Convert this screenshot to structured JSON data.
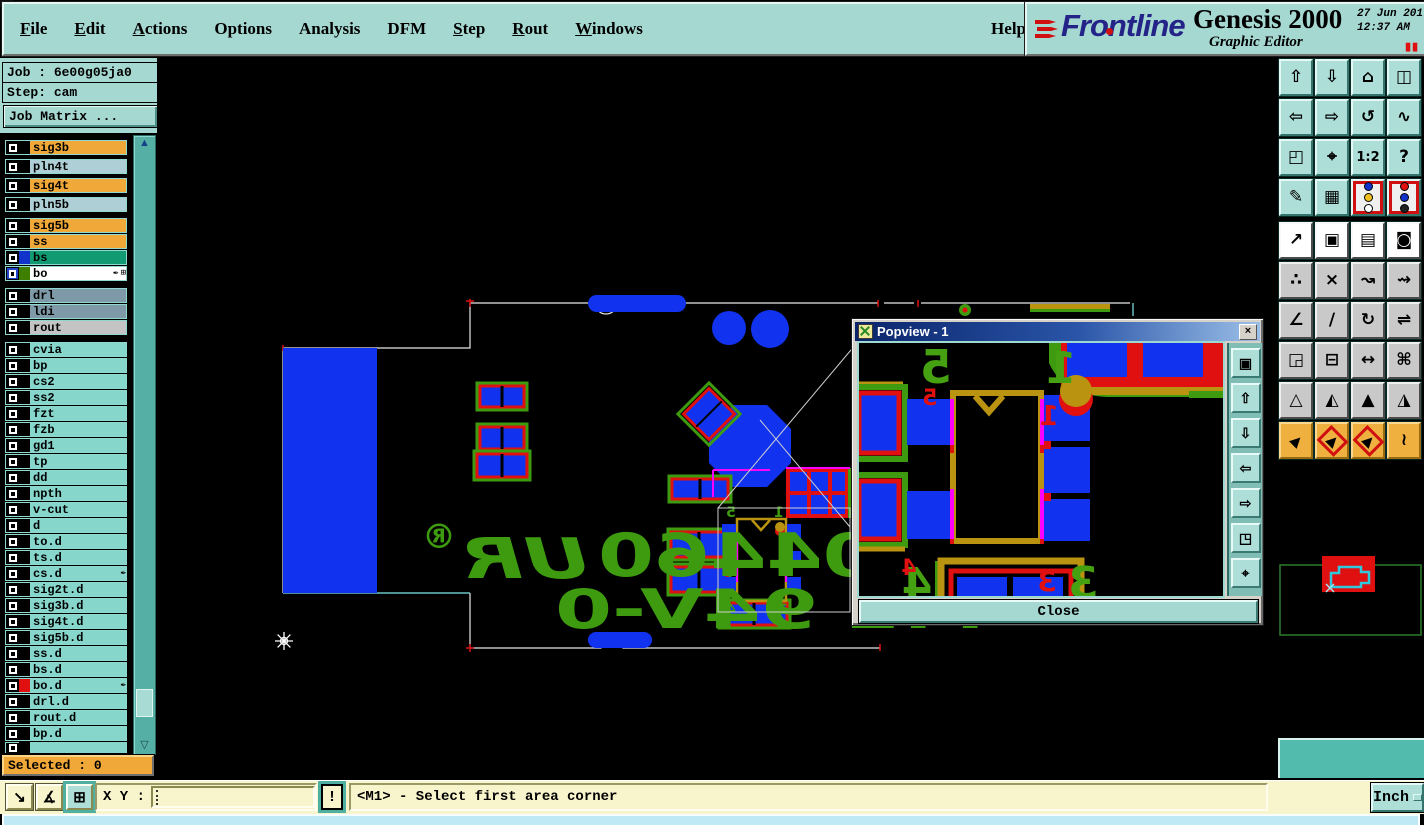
{
  "header": {
    "menus": [
      {
        "label": "File",
        "u": 0
      },
      {
        "label": "Edit",
        "u": 0
      },
      {
        "label": "Actions",
        "u": 0
      },
      {
        "label": "Options"
      },
      {
        "label": "Analysis"
      },
      {
        "label": "DFM"
      },
      {
        "label": "Step",
        "u": 0
      },
      {
        "label": "Rout",
        "u": 0
      },
      {
        "label": "Windows",
        "u": 0
      }
    ],
    "help": "Help",
    "brand": {
      "name": "Frontline",
      "product": "Genesis 2000",
      "date": "27 Jun 201",
      "time": "12:37 AM",
      "subtitle": "Graphic Editor",
      "pause_glyph": "▮▮"
    }
  },
  "sidebar": {
    "job_label": "Job : ",
    "job_value": "6e00g05ja0",
    "step_label": "Step: ",
    "step_value": "cam",
    "job_matrix": "Job Matrix ...",
    "selected": "Selected : 0",
    "layers": [
      {
        "name": "sig3b",
        "bg": "#F0A838",
        "mb": 4
      },
      {
        "name": "pln4t",
        "bg": "#AFCFD6",
        "mb": 4
      },
      {
        "name": "sig4t",
        "bg": "#F0A838",
        "mb": 4
      },
      {
        "name": "pln5b",
        "bg": "#AFCFD6",
        "mb": 6
      },
      {
        "name": "sig5b",
        "bg": "#F0A838"
      },
      {
        "name": "ss",
        "bg": "#F0A838"
      },
      {
        "name": "bs",
        "bg": "#129B72",
        "swatch": "#1133CC"
      },
      {
        "name": "bo",
        "bg": "#FFFFFF",
        "swatch": "#3F7F00",
        "icons": [
          "pen",
          "grid"
        ],
        "cbblue": true,
        "mb": 7
      },
      {
        "name": "drl",
        "bg": "#7E99A8"
      },
      {
        "name": "ldi",
        "bg": "#7E99A8"
      },
      {
        "name": "rout",
        "bg": "#C4C4C4",
        "mb": 7
      },
      {
        "name": "cvia",
        "bg": "#86D6CC"
      },
      {
        "name": "bp",
        "bg": "#86D6CC"
      },
      {
        "name": "cs2",
        "bg": "#86D6CC"
      },
      {
        "name": "ss2",
        "bg": "#86D6CC"
      },
      {
        "name": "fzt",
        "bg": "#86D6CC"
      },
      {
        "name": "fzb",
        "bg": "#86D6CC"
      },
      {
        "name": "gd1",
        "bg": "#86D6CC"
      },
      {
        "name": "tp",
        "bg": "#86D6CC"
      },
      {
        "name": "dd",
        "bg": "#86D6CC"
      },
      {
        "name": "npth",
        "bg": "#86D6CC"
      },
      {
        "name": "v-cut",
        "bg": "#86D6CC"
      },
      {
        "name": "d",
        "bg": "#86D6CC"
      },
      {
        "name": "to.d",
        "bg": "#86D6CC"
      },
      {
        "name": "ts.d",
        "bg": "#86D6CC"
      },
      {
        "name": "cs.d",
        "bg": "#86D6CC",
        "icons": [
          "pen"
        ]
      },
      {
        "name": "sig2t.d",
        "bg": "#86D6CC"
      },
      {
        "name": "sig3b.d",
        "bg": "#86D6CC"
      },
      {
        "name": "sig4t.d",
        "bg": "#86D6CC"
      },
      {
        "name": "sig5b.d",
        "bg": "#86D6CC"
      },
      {
        "name": "ss.d",
        "bg": "#86D6CC"
      },
      {
        "name": "bs.d",
        "bg": "#86D6CC"
      },
      {
        "name": "bo.d",
        "bg": "#86D6CC",
        "swatch": "#E01010",
        "icons": [
          "pen"
        ]
      },
      {
        "name": "drl.d",
        "bg": "#86D6CC"
      },
      {
        "name": "rout.d",
        "bg": "#86D6CC"
      },
      {
        "name": "bp.d",
        "bg": "#86D6CC"
      },
      {
        "name": "",
        "bg": "#86D6CC",
        "partial": true
      }
    ]
  },
  "right_toolbar": {
    "rows": [
      {
        "style": "teal",
        "buttons": [
          {
            "name": "view-pan-up-button",
            "glyph": "⇧"
          },
          {
            "name": "view-pan-down-button",
            "glyph": "⇩"
          },
          {
            "name": "view-home-button",
            "glyph": "⌂"
          },
          {
            "name": "view-split-button",
            "glyph": "◫"
          }
        ]
      },
      {
        "style": "teal",
        "buttons": [
          {
            "name": "view-pan-left-button",
            "glyph": "⇦"
          },
          {
            "name": "view-pan-right-button",
            "glyph": "⇨"
          },
          {
            "name": "view-previous-button",
            "glyph": "↺"
          },
          {
            "name": "serpentine-button",
            "glyph": "∿"
          }
        ]
      },
      {
        "style": "teal",
        "buttons": [
          {
            "name": "zoom-fit-button",
            "glyph": "◰"
          },
          {
            "name": "zoom-center-button",
            "glyph": "⌖"
          },
          {
            "name": "zoom-ratio-button",
            "glyph": "1:2",
            "cls": "small"
          },
          {
            "name": "help-pointer-button",
            "glyph": "?"
          }
        ]
      },
      {
        "style": "teal",
        "buttons": [
          {
            "name": "editor-setup-button",
            "glyph": "✎"
          },
          {
            "name": "grid-toggle-button",
            "glyph": "▦"
          },
          {
            "name": "display-config-button",
            "red": true,
            "dots": [
              "#1133CC",
              "#F0C020",
              "#FFFFFF"
            ]
          },
          {
            "name": "snap-config-button",
            "red": true,
            "dots": [
              "#E01010",
              "#1133CC",
              "#222222"
            ]
          }
        ]
      },
      {
        "style": "white",
        "gap_before": true,
        "buttons": [
          {
            "name": "transform-button",
            "glyph": "↗"
          },
          {
            "name": "layer-compare-button",
            "glyph": "▣"
          },
          {
            "name": "ruler-button",
            "glyph": "▤"
          },
          {
            "name": "pad-capture-button",
            "glyph": "◙"
          }
        ]
      },
      {
        "style": "gray",
        "buttons": [
          {
            "name": "net-highlight-button",
            "glyph": "∴"
          },
          {
            "name": "erase-button",
            "glyph": "×"
          },
          {
            "name": "move-to-layer-button",
            "glyph": "↝"
          },
          {
            "name": "copy-to-layer-button",
            "glyph": "⇝"
          }
        ]
      },
      {
        "style": "gray",
        "buttons": [
          {
            "name": "angle-button",
            "glyph": "∠"
          },
          {
            "name": "slope-button",
            "glyph": "∕"
          },
          {
            "name": "arc-button",
            "glyph": "↻"
          },
          {
            "name": "mirror-button",
            "glyph": "⇌"
          }
        ]
      },
      {
        "style": "gray",
        "buttons": [
          {
            "name": "pad-swap-button",
            "glyph": "◲"
          },
          {
            "name": "line-break-button",
            "glyph": "⊟"
          },
          {
            "name": "measure-distance-button",
            "glyph": "↔"
          },
          {
            "name": "surface-button",
            "glyph": "⌘"
          }
        ]
      },
      {
        "style": "gray",
        "buttons": [
          {
            "name": "triangle-open-button",
            "glyph": "△"
          },
          {
            "name": "triangle-left-button",
            "glyph": "◭"
          },
          {
            "name": "triangle-filled-button",
            "glyph": "▲"
          },
          {
            "name": "triangle-right-button",
            "glyph": "◮"
          }
        ]
      },
      {
        "style": "orange",
        "buttons": [
          {
            "name": "select-pointer-button",
            "glyph": "▶",
            "cls": "ne"
          },
          {
            "name": "select-rect-button",
            "glyph": "▶",
            "cls": "ne boxed"
          },
          {
            "name": "select-poly-button",
            "glyph": "▶",
            "cls": "ne boxed"
          },
          {
            "name": "select-net-button",
            "glyph": "≀"
          }
        ]
      }
    ]
  },
  "popview": {
    "title": "Popview - 1",
    "close_glyph": "×",
    "close_label": "Close",
    "side_buttons": [
      {
        "name": "popview-detach-button",
        "glyph": "▣"
      },
      {
        "name": "popview-pan-up-button",
        "glyph": "⇧"
      },
      {
        "name": "popview-pan-down-button",
        "glyph": "⇩"
      },
      {
        "name": "popview-pan-left-button",
        "glyph": "⇦"
      },
      {
        "name": "popview-pan-right-button",
        "glyph": "⇨"
      },
      {
        "name": "popview-zoom-out-button",
        "glyph": "◳"
      },
      {
        "name": "popview-zoom-in-button",
        "glyph": "⌖"
      }
    ]
  },
  "statusbar": {
    "tools": [
      {
        "name": "measure-mode-button",
        "glyph": "↘"
      },
      {
        "name": "angle-mode-button",
        "glyph": "∡"
      },
      {
        "name": "grid-mode-button",
        "glyph": "⊞",
        "active": true
      }
    ],
    "xy_label": "X Y :",
    "xy_value": "",
    "alert": "!",
    "message": "<M1> - Select first area corner",
    "unit": "Inch"
  },
  "coords": {
    "x": "X = 2.438846\"",
    "y": "Y = -4.428969\""
  },
  "pcb": {
    "silk_line1": "E204460",
    "silk_ur": "UR",
    "silk_reg": "®",
    "silk_line2": "M1 94V-0",
    "pins": {
      "1": "1",
      "3": "3",
      "4": "4",
      "5": "5"
    }
  }
}
